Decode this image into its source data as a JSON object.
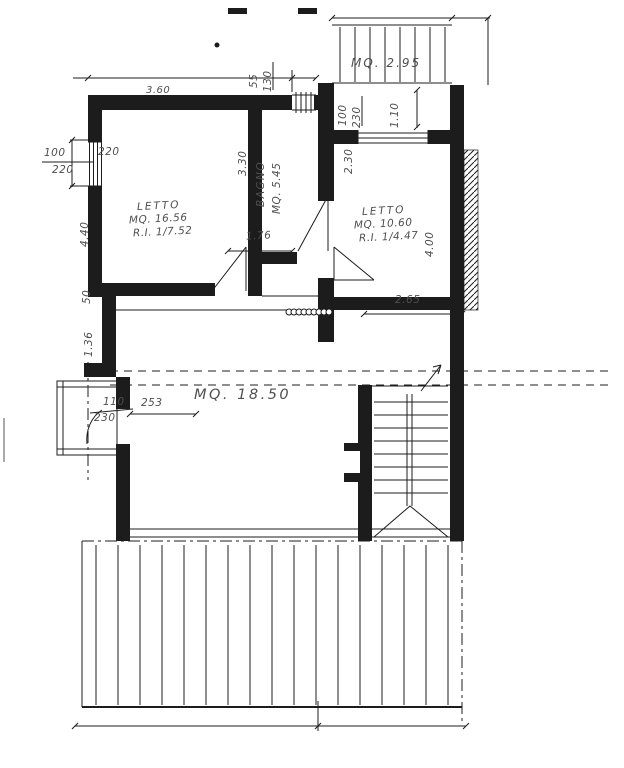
{
  "drawing": {
    "type": "floor-plan (scanned, Italian)",
    "ink_color": "#1c1c1c",
    "pencil_color": "#4f4f4f",
    "paper_color": "#ffffff"
  },
  "rooms": [
    {
      "name": "LETTO",
      "area": "MQ. 16.56",
      "ratio": "R.I. 1/7.52"
    },
    {
      "name": "BAGNO",
      "area": "MQ. 5.45",
      "ratio": ""
    },
    {
      "name": "LETTO",
      "area": "MQ. 10.60",
      "ratio": "R.I. 1/4.47"
    },
    {
      "name": "",
      "area": "MQ. 18.50",
      "ratio": ""
    },
    {
      "name": "",
      "area": "MQ. 2.95",
      "ratio": ""
    }
  ],
  "dims": {
    "top_width": "3.60",
    "top_window_w": "55",
    "top_window_h": "130",
    "left_window_w": "100",
    "left_window_h": "220",
    "left_window_sill": "220",
    "letto1_depth": "4.40",
    "closet_depth": "50",
    "hall_depth": "1.36",
    "bagno_depth": "3.30",
    "corridor_w": "1.76",
    "letto2_w": "2.65",
    "letto2_depth": "4.00",
    "letto2_sill": "2.30",
    "balcony_door_w": "100",
    "balcony_door_h": "230",
    "balcony_depth": "1.10",
    "west_door_w": "110",
    "west_door_h": "230",
    "west_offset": "253"
  }
}
